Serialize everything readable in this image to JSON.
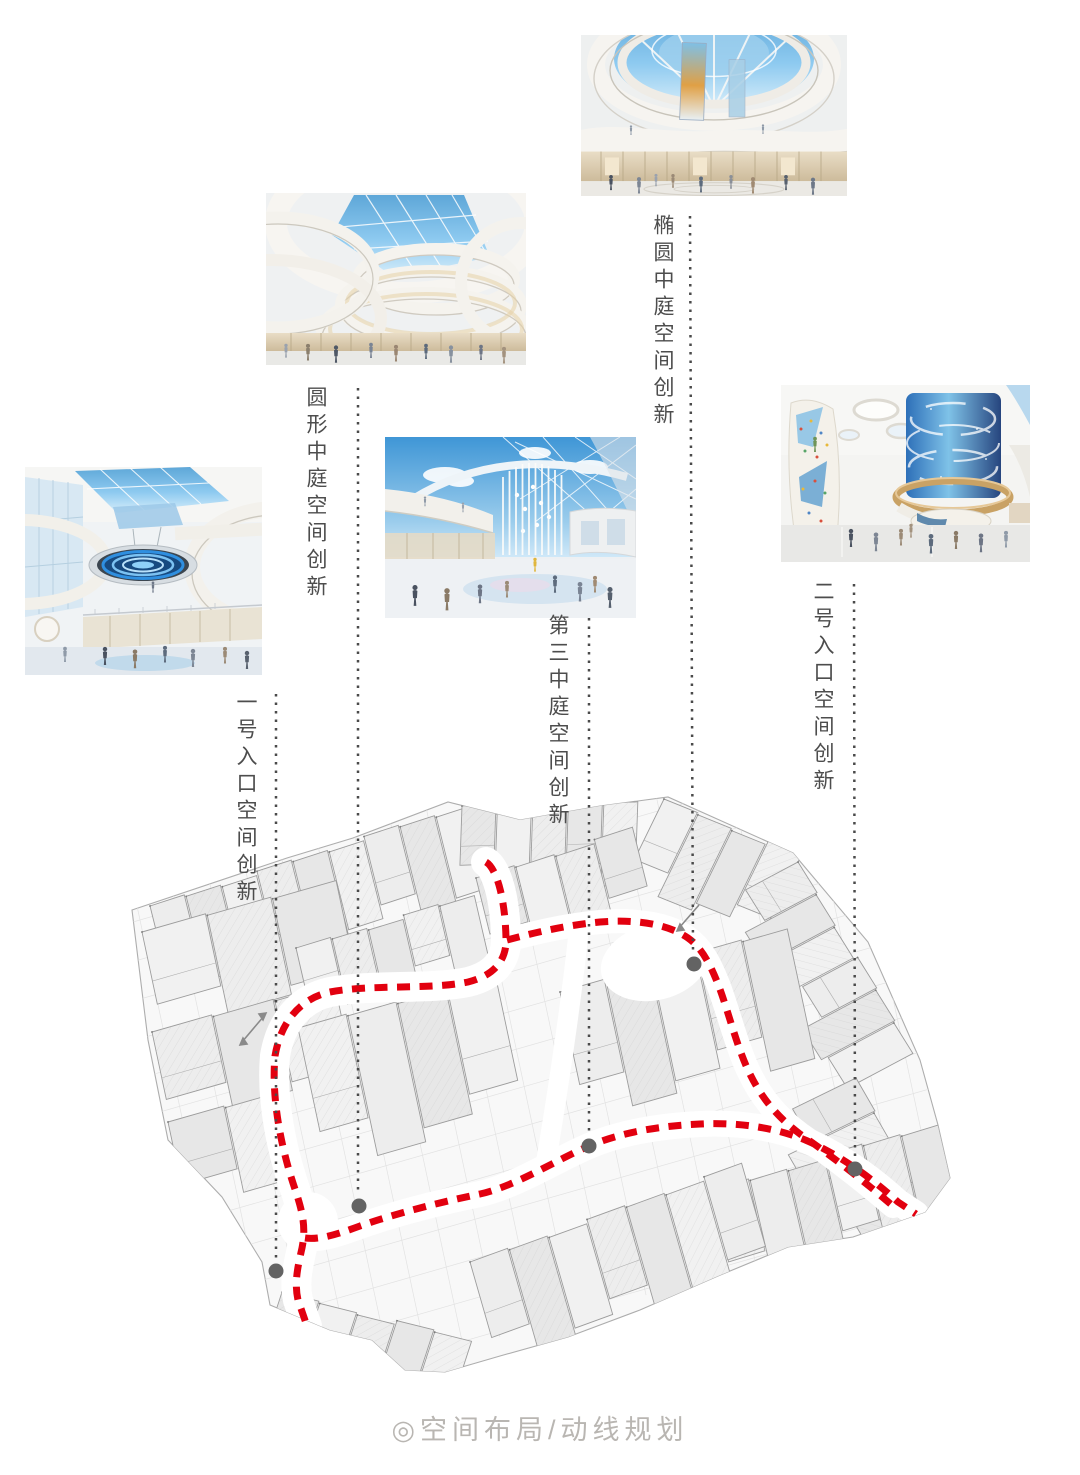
{
  "callouts": [
    {
      "id": "oval-atrium",
      "label": "椭圆中庭空间创新"
    },
    {
      "id": "round-atrium",
      "label": "圆形中庭空间创新"
    },
    {
      "id": "entrance-1",
      "label": "一号入口空间创新"
    },
    {
      "id": "atrium-3",
      "label": "第三中庭空间创新"
    },
    {
      "id": "entrance-2",
      "label": "二号入口空间创新"
    }
  ],
  "caption": {
    "prefix_icon": "◎",
    "text": "空间布局/动线规划"
  },
  "colors": {
    "route_red": "#e2000f",
    "leader_gray": "#4a4a4a",
    "marker_gray": "#636363",
    "label_text": "#4d4d4d",
    "caption_gray": "#b9b6b2"
  }
}
